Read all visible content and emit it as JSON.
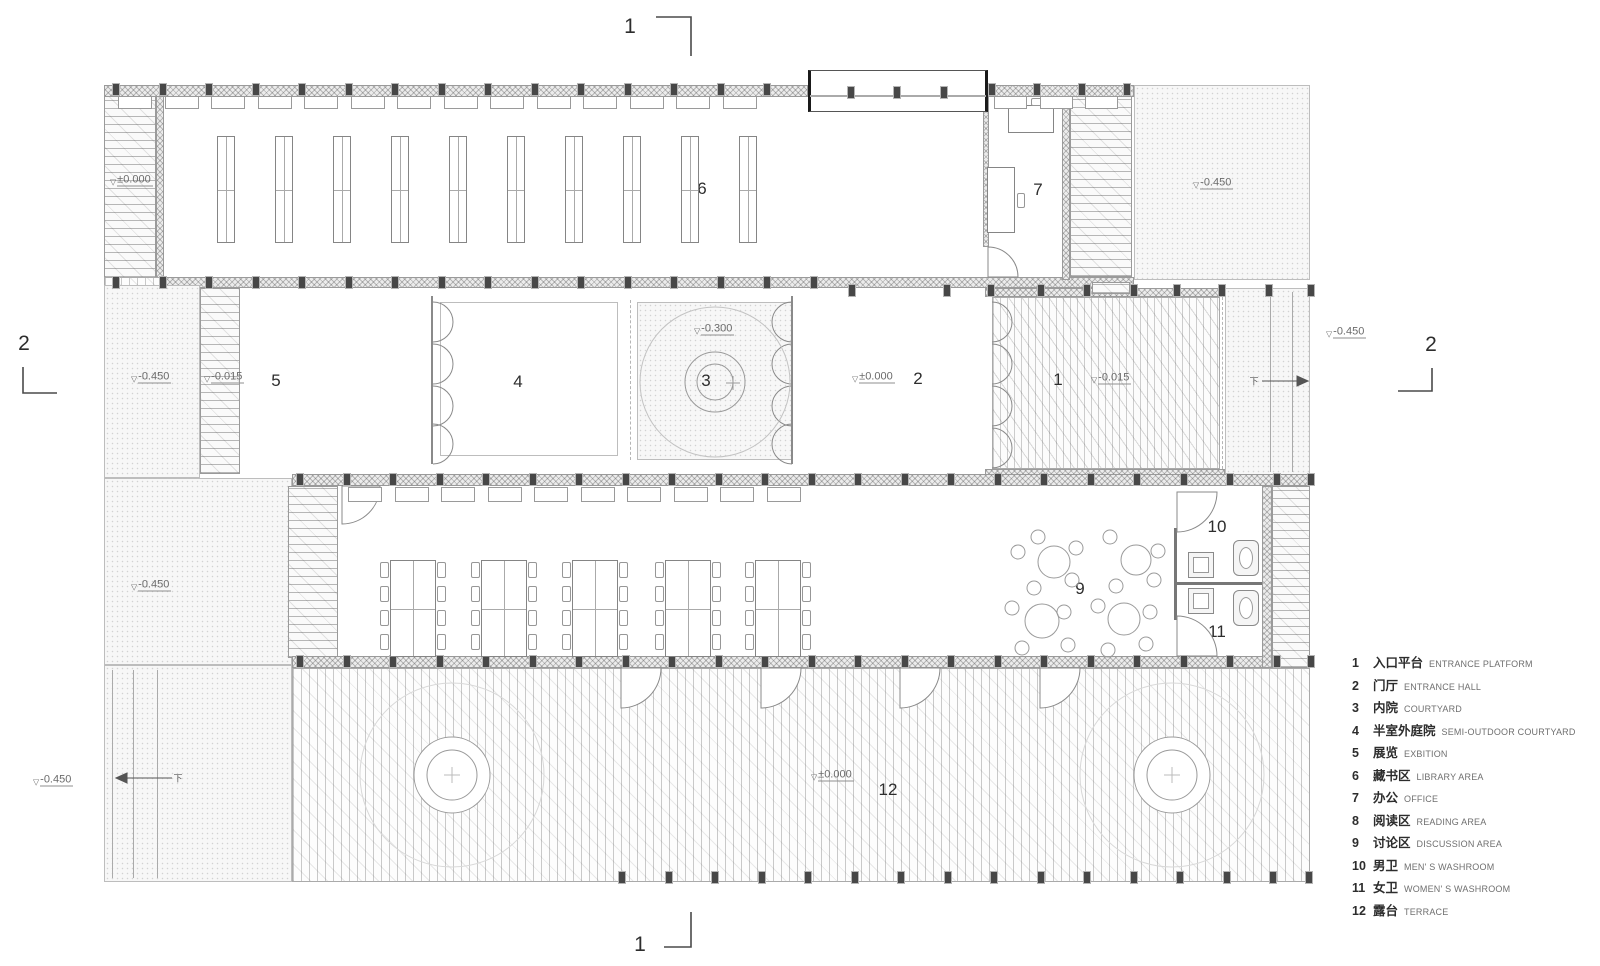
{
  "drawing": {
    "section_markers": {
      "top": "1",
      "bottom": "1",
      "left": "2",
      "right": "2"
    },
    "room_labels": {
      "r1": "1",
      "r2": "2",
      "r3": "3",
      "r4": "4",
      "r5": "5",
      "r6": "6",
      "r7": "7",
      "r8": "8",
      "r9": "9",
      "r10": "10",
      "r11": "11",
      "r12": "12"
    },
    "elevations": {
      "library_platform": "±0.000",
      "north_yard": "-0.450",
      "west_yard_upper": "-0.450",
      "west_wall": "-0.015",
      "courtyard": "-0.300",
      "entrance_hall": "±0.000",
      "entrance_platform": "-0.015",
      "east_yard": "-0.450",
      "west_yard_lower": "-0.450",
      "southwest_yard": "-0.450",
      "terrace": "±0.000"
    },
    "stair_direction_label": "下",
    "legend": {
      "items": [
        {
          "num": "1",
          "zh": "入口平台",
          "en": "ENTRANCE PLATFORM"
        },
        {
          "num": "2",
          "zh": "门厅",
          "en": "ENTRANCE HALL"
        },
        {
          "num": "3",
          "zh": "内院",
          "en": "COURTYARD"
        },
        {
          "num": "4",
          "zh": "半室外庭院",
          "en": "SEMI-OUTDOOR COURTYARD"
        },
        {
          "num": "5",
          "zh": "展览",
          "en": "EXBITION"
        },
        {
          "num": "6",
          "zh": "藏书区",
          "en": "LIBRARY AREA"
        },
        {
          "num": "7",
          "zh": "办公",
          "en": "OFFICE"
        },
        {
          "num": "8",
          "zh": "阅读区",
          "en": "READING AREA"
        },
        {
          "num": "9",
          "zh": "讨论区",
          "en": "DISCUSSION AREA"
        },
        {
          "num": "10",
          "zh": "男卫",
          "en": "MEN' S WASHROOM"
        },
        {
          "num": "11",
          "zh": "女卫",
          "en": "WOMEN' S WASHROOM"
        },
        {
          "num": "12",
          "zh": "露台",
          "en": "TERRACE"
        }
      ]
    }
  },
  "colors": {
    "paper": "#ffffff",
    "line": "#777777",
    "dark": "#3f3f3f",
    "text": "#3a3a3a",
    "muted": "#8a8a8a"
  }
}
